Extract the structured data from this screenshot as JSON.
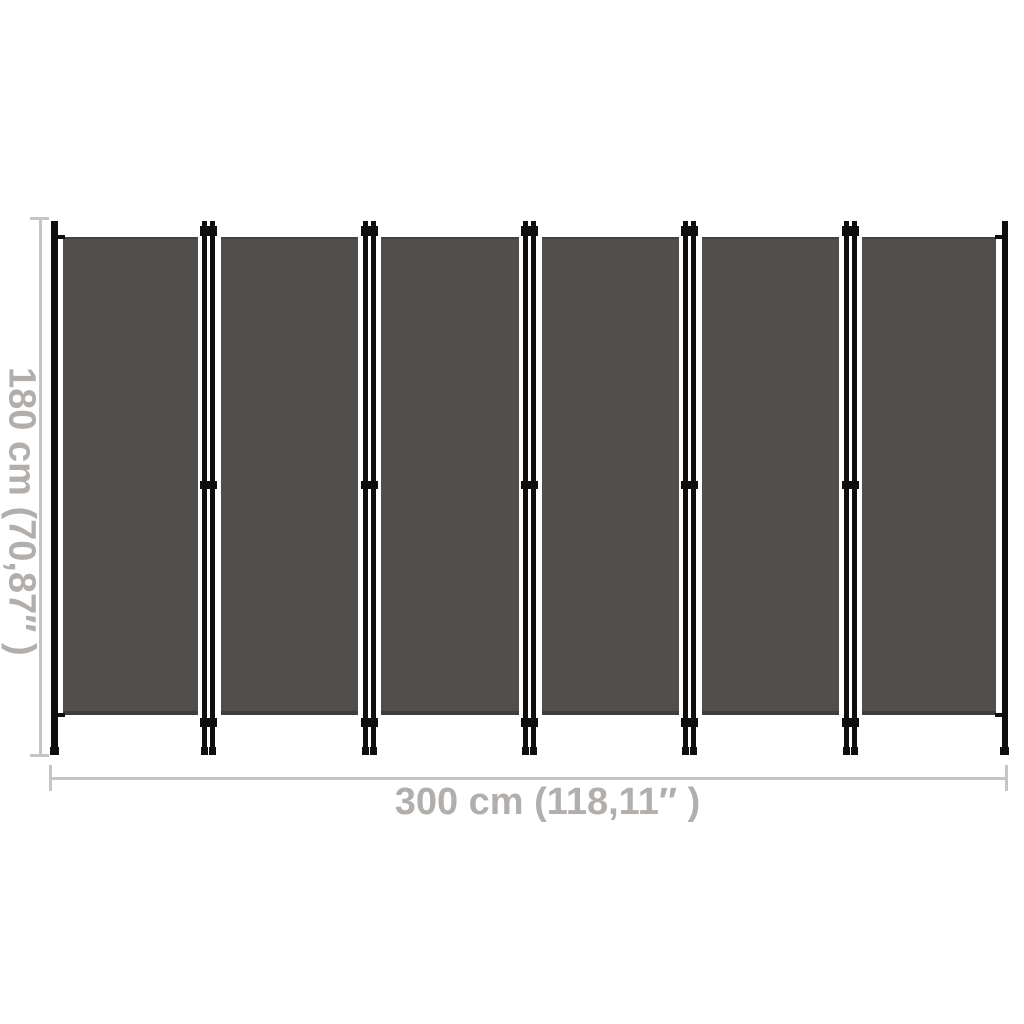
{
  "image": {
    "description": "Dimension diagram of a 6-panel folding room divider privacy screen",
    "background_color": "#ffffff"
  },
  "divider": {
    "panel_count": 6,
    "hinge_count": 5,
    "fabric_color": "#524e4b",
    "frame_color": "#0e0e0e"
  },
  "dimensions": {
    "height_label": "180 cm (70,87″ )",
    "width_label": "300 cm (118,11″ )",
    "line_color": "#c7c5c3",
    "text_color": "#b1aeac"
  }
}
